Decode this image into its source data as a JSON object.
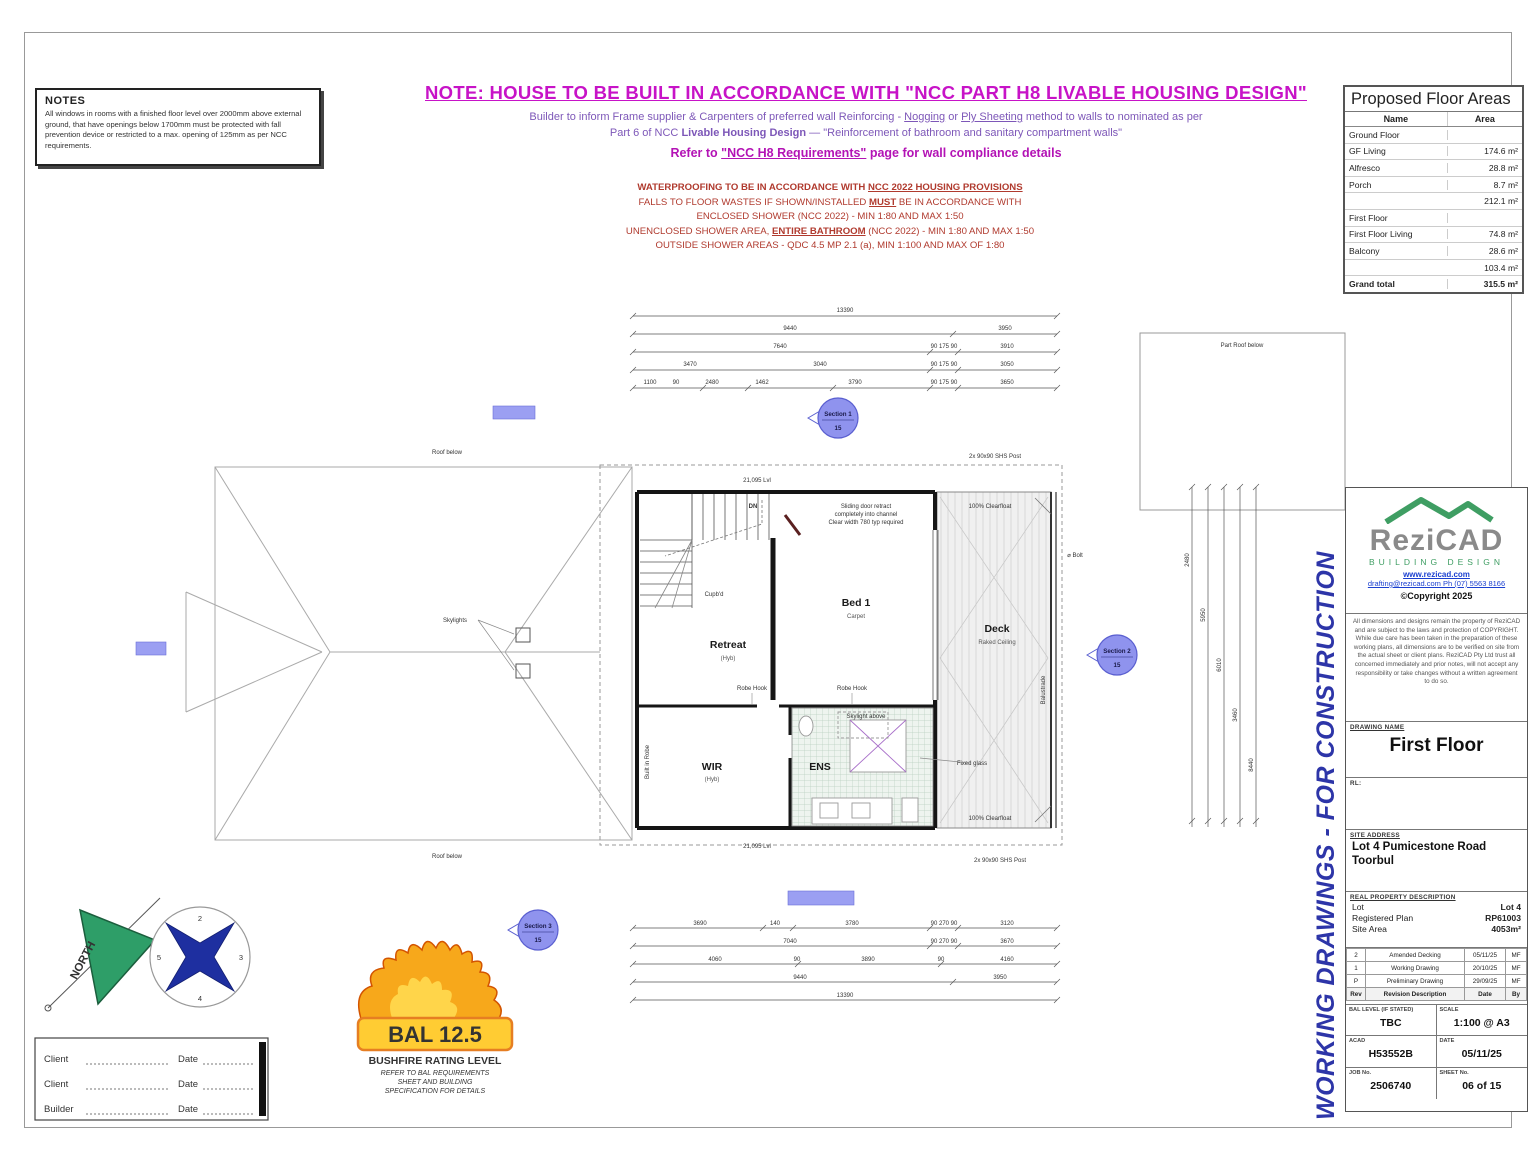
{
  "notes": {
    "title": "NOTES",
    "body": "All windows in rooms with a finished floor level over 2000mm above external ground, that have openings below 1700mm must be protected with fall prevention device or restricted to a max. opening of 125mm as per NCC requirements."
  },
  "header": {
    "title": "NOTE: HOUSE TO BE BUILT IN ACCORDANCE WITH \"NCC PART H8 LIVABLE HOUSING DESIGN\"",
    "l2a": "Builder to inform Frame supplier & Carpenters of preferred wall Reinforcing - ",
    "l2b": "Nogging",
    "l2c": " or ",
    "l2d": "Ply Sheeting",
    "l2e": " method to walls to nominated as per",
    "l3a": "Part 6 of NCC ",
    "l3b": "Livable Housing Design",
    "l3c": " — \"Reinforcement of bathroom and sanitary compartment walls\"",
    "l4a": "Refer to ",
    "l4b": "\"NCC H8 Requirements\"",
    "l4c": " page for wall compliance details"
  },
  "red": {
    "l1a": "WATERPROOFING TO BE IN ACCORDANCE WITH ",
    "l1b": "NCC 2022 HOUSING PROVISIONS",
    "l2a": "FALLS TO FLOOR WASTES IF SHOWN/INSTALLED ",
    "l2b": "MUST",
    "l2c": " BE IN ACCORDANCE WITH",
    "line3": "ENCLOSED SHOWER (NCC 2022) - MIN 1:80 AND MAX 1:50",
    "l4a": "UNENCLOSED SHOWER AREA, ",
    "l4b": "ENTIRE BATHROOM",
    "l4c": " (NCC 2022) - MIN 1:80 AND MAX 1:50",
    "line5": "OUTSIDE SHOWER AREAS - QDC 4.5 MP 2.1 (a), MIN 1:100 AND MAX OF 1:80"
  },
  "floor_areas": {
    "title": "Proposed Floor Areas",
    "col_name": "Name",
    "col_area": "Area",
    "rows": [
      {
        "name": "Ground Floor",
        "area": ""
      },
      {
        "name": "GF Living",
        "area": "174.6 m²"
      },
      {
        "name": "Alfresco",
        "area": "28.8 m²"
      },
      {
        "name": "Porch",
        "area": "8.7 m²"
      },
      {
        "name": "",
        "area": "212.1 m²"
      },
      {
        "name": "First Floor",
        "area": ""
      },
      {
        "name": "First Floor Living",
        "area": "74.8 m²"
      },
      {
        "name": "Balcony",
        "area": "28.6 m²"
      },
      {
        "name": "",
        "area": "103.4 m²"
      },
      {
        "name": "Grand total",
        "area": "315.5 m²"
      }
    ]
  },
  "plan": {
    "rooms": {
      "retreat": {
        "n": "Retreat",
        "f": "(Hyb)"
      },
      "bed1": {
        "n": "Bed 1",
        "f": "Carpet"
      },
      "deck": {
        "n": "Deck",
        "f": "Raked Ceiling"
      },
      "wir": {
        "n": "WIR",
        "f": "(Hyb)"
      },
      "ens": {
        "n": "ENS"
      }
    },
    "ann": {
      "roof_top": "Roof below",
      "roof_bot": "Roof below",
      "part_roof": "Part Roof below",
      "skylights": "Skylights",
      "skylight_above": "Skylight above",
      "fixed_glass": "Fixed glass",
      "dn": "DN",
      "slide1": "Sliding door retract",
      "slide2": "completely into channel",
      "slide3": "Clear width 780 typ required",
      "robe1": "Robe Hook",
      "robe2": "Robe Hook",
      "lvl_top": "21,095 Lvl",
      "lvl_bot": "21,095 Lvl",
      "post_top": "2x 90x90 SHS Post",
      "post_bot": "2x 90x90 SHS Post",
      "balustrade": "Balustrade",
      "clear_top": "100% Clearfloat",
      "clear_bot": "100% Clearfloat",
      "cupbd": "Cupb'd",
      "bir": "Built in Robe",
      "bolt": "⌀ Bolt"
    }
  },
  "dims": {
    "top": [
      [
        "13390"
      ],
      [
        "9440",
        "3950"
      ],
      [
        "7640",
        "90 175 90",
        "3910"
      ],
      [
        "3470",
        "3040",
        "90 175 90",
        "3050"
      ],
      [
        "1100",
        "90",
        "2480",
        "1462",
        "3790",
        "90 175 90",
        "3650"
      ]
    ],
    "bottom": [
      [
        "3690",
        "140",
        "3780",
        "90 270 90",
        "3120"
      ],
      [
        "7040",
        "90 270 90",
        "3670"
      ],
      [
        "4060",
        "90",
        "3890",
        "90",
        "4160"
      ],
      [
        "9440",
        "3950"
      ],
      [
        "13390"
      ]
    ],
    "right": [
      "2480",
      "5950",
      "6010",
      "3460",
      "8440"
    ]
  },
  "sections": [
    {
      "l": "Section 1",
      "s": "15"
    },
    {
      "l": "Section 2",
      "s": "15"
    },
    {
      "l": "Section 3",
      "s": "15"
    }
  ],
  "compass": {
    "north": "NORTH",
    "n": "2",
    "e": "3",
    "s": "4",
    "w": "5"
  },
  "bal": {
    "badge": "BAL 12.5",
    "title": "BUSHFIRE RATING LEVEL",
    "sub1": "REFER TO BAL REQUIREMENTS",
    "sub2": "SHEET AND BUILDING",
    "sub3": "SPECIFICATION FOR DETAILS"
  },
  "sign": {
    "rows": [
      {
        "label": "Client",
        "date": "Date"
      },
      {
        "label": "Client",
        "date": "Date"
      },
      {
        "label": "Builder",
        "date": "Date"
      }
    ]
  },
  "wd": "WORKING DRAWINGS - FOR CONSTRUCTION",
  "tb": {
    "logo": {
      "name": "ReziCAD",
      "tag": "BUILDING DESIGN",
      "web": "www.rezicad.com",
      "mail": "drafting@rezicad.com Ph (07) 5563 8166",
      "copy": "©Copyright 2025",
      "disclaimer": "All dimensions and designs remain the property of ReziCAD and are subject to the laws and protection of COPYRIGHT. While due care has been taken in the preparation of these working plans, all dimensions are to be verified on site from the actual sheet or client plans. ReziCAD Pty Ltd trust all concerned immediately and prior notes, will not accept any responsibility or take changes without a written agreement to do so."
    },
    "drawing": {
      "label": "DRAWING NAME",
      "name": "First Floor"
    },
    "rl": "RL:",
    "site": {
      "label": "SITE ADDRESS",
      "a1": "Lot 4 Pumicestone Road",
      "a2": "Toorbul"
    },
    "rpd": {
      "label": "REAL PROPERTY DESCRIPTION",
      "lot_l": "Lot",
      "lot": "Lot 4",
      "plan_l": "Registered Plan",
      "plan": "RP61003",
      "area_l": "Site Area",
      "area": "4053m²"
    },
    "revs": [
      {
        "rev": "2",
        "desc": "Amended Decking",
        "date": "05/11/25",
        "by": "MF"
      },
      {
        "rev": "1",
        "desc": "Working Drawing",
        "date": "20/10/25",
        "by": "MF"
      },
      {
        "rev": "P",
        "desc": "Preliminary Drawing",
        "date": "29/09/25",
        "by": "MF"
      }
    ],
    "rev_h": {
      "rev": "Rev",
      "desc": "Revision Description",
      "date": "Date",
      "by": "By"
    },
    "grid": {
      "bal_l": "BAL LEVEL (IF STATED)",
      "bal": "TBC",
      "scale_l": "SCALE",
      "scale": "1:100 @ A3",
      "acad_l": "ACAD",
      "acad": "H53552B",
      "date_l": "DATE",
      "date": "05/11/25",
      "job_l": "JOB No.",
      "job": "2506740",
      "sheet_l": "SHEET No.",
      "sheet": "06 of 15"
    }
  },
  "colors": {
    "magenta": "#c713c7",
    "purple": "#7d57b8",
    "red": "#b03a2e",
    "blue": "#2d35a8",
    "section_fill": "#8f93ee",
    "highlight": "#9b9ff2",
    "north_green": "#2e9e68",
    "star_blue": "#1e2fa0",
    "logo_green": "#3f9e63"
  }
}
